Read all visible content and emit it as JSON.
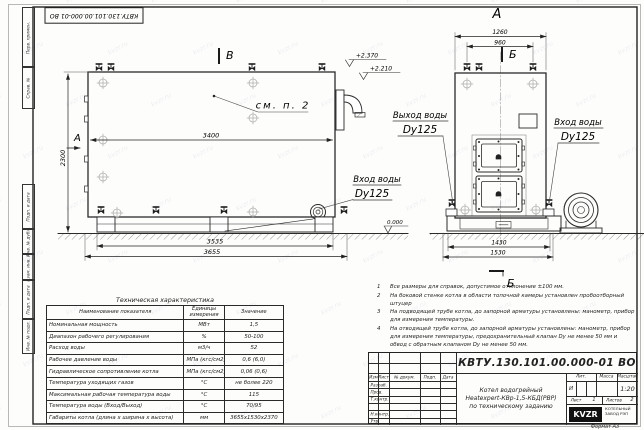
{
  "sheet": {
    "doc_number_rotated": "КВТУ.130.101.00.000-01 ВО",
    "format_note": "Формат А3",
    "margin_labels": [
      "Перв. примен.",
      "Справ. №",
      "Подп. и дата",
      "Инв. № дубл.",
      "Взам. инв. №",
      "Подп. и дата",
      "Инв. № подл."
    ],
    "watermark": "kvzr.ru"
  },
  "side_view": {
    "section_label": "В",
    "view_arrow_label": "А",
    "callout": "см. п. 2",
    "dims": {
      "shell_length": "3400",
      "height": "2300",
      "base_length": "3535",
      "overall_length": "3655"
    },
    "elevations": {
      "top": "+2.370",
      "shell": "+2.210",
      "ground": "0.000"
    },
    "inlet": {
      "line1": "Вход воды",
      "line2": "Dy125"
    }
  },
  "front_view": {
    "view_label": "А",
    "section_label_top": "Б",
    "section_label_bottom": "Б",
    "dims": {
      "overall_width_top": "1260",
      "valve_spacing": "960",
      "base_width": "1430",
      "overall_width": "1530"
    },
    "outlet": {
      "line1": "Выход воды",
      "line2": "Dy125"
    },
    "inlet": {
      "line1": "Вход воды",
      "line2": "Dy125"
    }
  },
  "notes": [
    {
      "num": "1",
      "text": "Все размеры для справок, допустимое отклонение ±100 мм."
    },
    {
      "num": "2",
      "text": "На боковой стенке котла в области топочной камеры установлен пробоотборный штуцер"
    },
    {
      "num": "3",
      "text": "На подводящей трубе котла, до запорной арматуры установлены: манометр, прибор для измерения температуры."
    },
    {
      "num": "4",
      "text": "На отводящей трубе котла, до запорной арматуры установлены: манометр, прибор для измерения температуры, предохранительный клапан Dу не менее 50 мм и обвод с обратным клапаном Dу не менее 50 мм."
    }
  ],
  "spec_table": {
    "title": "Техническая характеристика",
    "headers": [
      "Наименование показателя",
      "Единицы измерения",
      "Значение"
    ],
    "rows": [
      [
        "Номинальная мощность",
        "МВт",
        "1,5"
      ],
      [
        "Диапазон рабочего регулирования",
        "%",
        "50-100"
      ],
      [
        "Расход воды",
        "м3/ч",
        "52"
      ],
      [
        "Рабочее давление воды",
        "МПа (кгс/см2)",
        "0,6 (6,0)"
      ],
      [
        "Гидравлическое сопротивление котла",
        "МПа (кгс/см2)",
        "0,06 (0,6)"
      ],
      [
        "Температура уходящих газов",
        "°С",
        "не более 220"
      ],
      [
        "Максимальная рабочая температура воды",
        "°С",
        "115"
      ],
      [
        "Температура воды (Вход/Выход)",
        "°С",
        "70/95"
      ],
      [
        "Габариты котла (длина х ширина х высота)",
        "мм",
        "3655х1530х2370"
      ]
    ]
  },
  "title_block": {
    "doc_number": "КВТУ.130.101.00.000-01 ВО",
    "product_lines": [
      "Котел водогрейный",
      "Heatexpert-КВр-1,5-КБД(РВР)",
      "по техническому заданию"
    ],
    "rev_headers": [
      "Изм",
      "Лист",
      "№ докум.",
      "Подп.",
      "Дата"
    ],
    "row_labels": [
      "Разраб.",
      "Пров.",
      "Т.контр.",
      "",
      "Н.контр.",
      "Утв."
    ],
    "lit_header": "Лит.",
    "mass_header": "Масса",
    "scale_header": "Масштаб",
    "lit_value": "И",
    "scale_value": "1:20",
    "sheet_label": "Лист",
    "sheet_value": "1",
    "sheets_label": "Листов",
    "sheets_value": "2",
    "logo_text": "KVZR",
    "company": "КОТЕЛЬНЫЙ ЗАВОД РЭП"
  }
}
